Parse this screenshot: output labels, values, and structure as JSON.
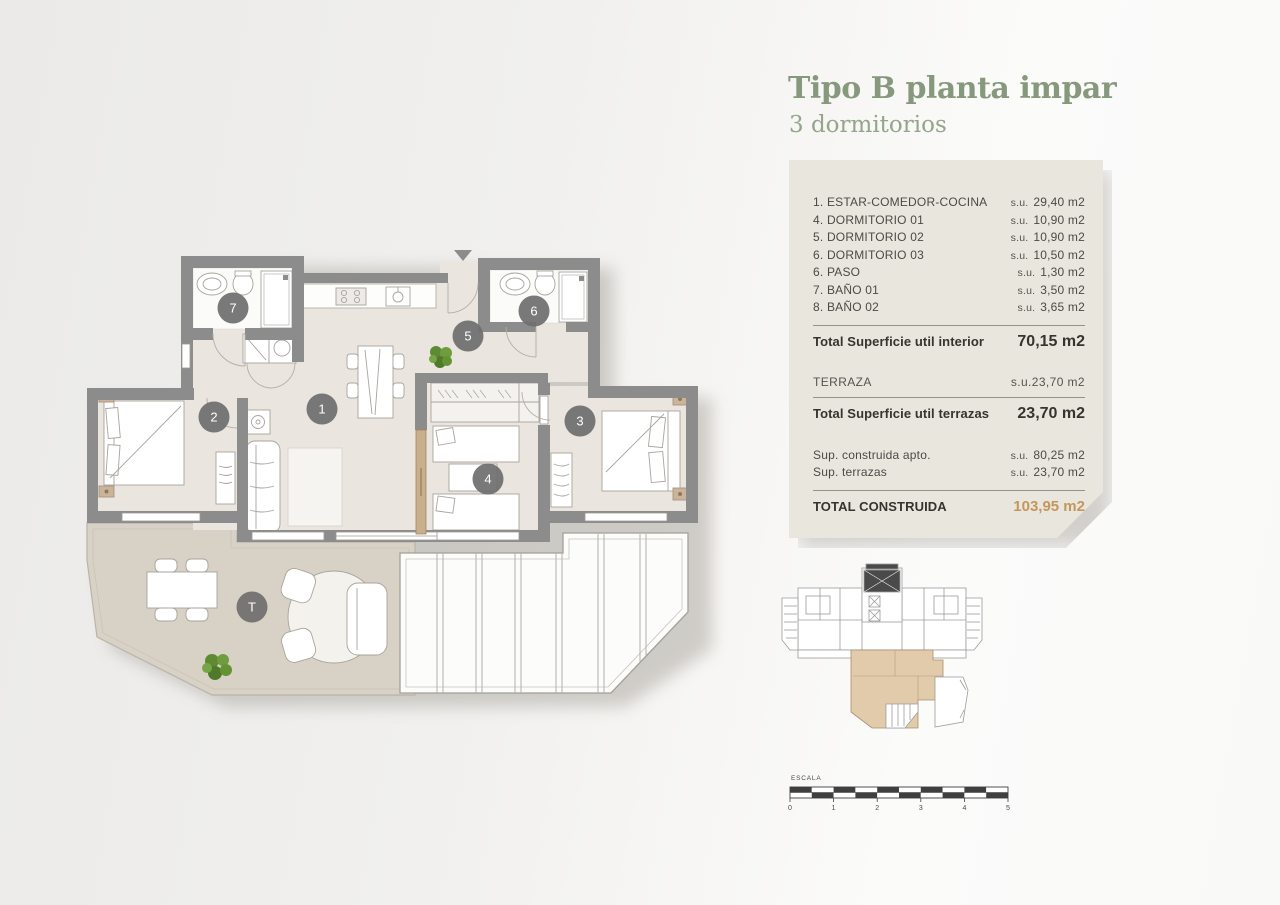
{
  "header": {
    "title": "Tipo B planta impar",
    "subtitle": "3 dormitorios"
  },
  "panel": {
    "rooms": [
      {
        "label": "1. ESTAR-COMEDOR-COCINA",
        "su": "s.u.",
        "area": "29,40 m2"
      },
      {
        "label": "4. DORMITORIO 01",
        "su": "s.u.",
        "area": "10,90 m2"
      },
      {
        "label": "5. DORMITORIO 02",
        "su": "s.u.",
        "area": "10,90 m2"
      },
      {
        "label": "6. DORMITORIO 03",
        "su": "s.u.",
        "area": "10,50 m2"
      },
      {
        "label": "6. PASO",
        "su": "s.u.",
        "area": "1,30 m2"
      },
      {
        "label": "7. BAÑO 01",
        "su": "s.u.",
        "area": "3,50 m2"
      },
      {
        "label": "8. BAÑO 02",
        "su": "s.u.",
        "area": "3,65 m2"
      }
    ],
    "total_interior": {
      "label": "Total Superficie util interior",
      "value": "70,15 m2"
    },
    "terraza": {
      "label": "TERRAZA",
      "su": "s.u.",
      "value": "23,70 m2"
    },
    "total_terrazas": {
      "label": "Total Superficie util terrazas",
      "value": "23,70 m2"
    },
    "construida": [
      {
        "label": "Sup. construida apto.",
        "su": "s.u.",
        "area": "80,25 m2"
      },
      {
        "label": "Sup. terrazas",
        "su": "s.u.",
        "area": "23,70 m2"
      }
    ],
    "total_construida": {
      "label": "TOTAL CONSTRUIDA",
      "value": "103,95 m2"
    }
  },
  "floorplan": {
    "badges": [
      {
        "id": "7",
        "x": 233,
        "y": 308
      },
      {
        "id": "6",
        "x": 534,
        "y": 311
      },
      {
        "id": "5",
        "x": 468,
        "y": 336
      },
      {
        "id": "1",
        "x": 322,
        "y": 409
      },
      {
        "id": "2",
        "x": 214,
        "y": 417
      },
      {
        "id": "3",
        "x": 580,
        "y": 421
      },
      {
        "id": "4",
        "x": 488,
        "y": 479
      },
      {
        "id": "T",
        "x": 252,
        "y": 607
      }
    ]
  },
  "scalebar": {
    "label": "ESCALA",
    "ticks": [
      "0",
      "1",
      "2",
      "3",
      "4",
      "5"
    ],
    "segments": 10
  },
  "colors": {
    "accent_green": "#87997d",
    "accent_green_light": "#94a58b",
    "accent_orange": "#c5965c",
    "wall_gray": "#8c8c8c",
    "floor_beige": "#eae5de",
    "terrace_beige": "#d8d1c6",
    "panel_bg": "#e9e6de",
    "badge_gray": "#6f6f6f",
    "minimap_highlight": "#e2cbaa"
  }
}
